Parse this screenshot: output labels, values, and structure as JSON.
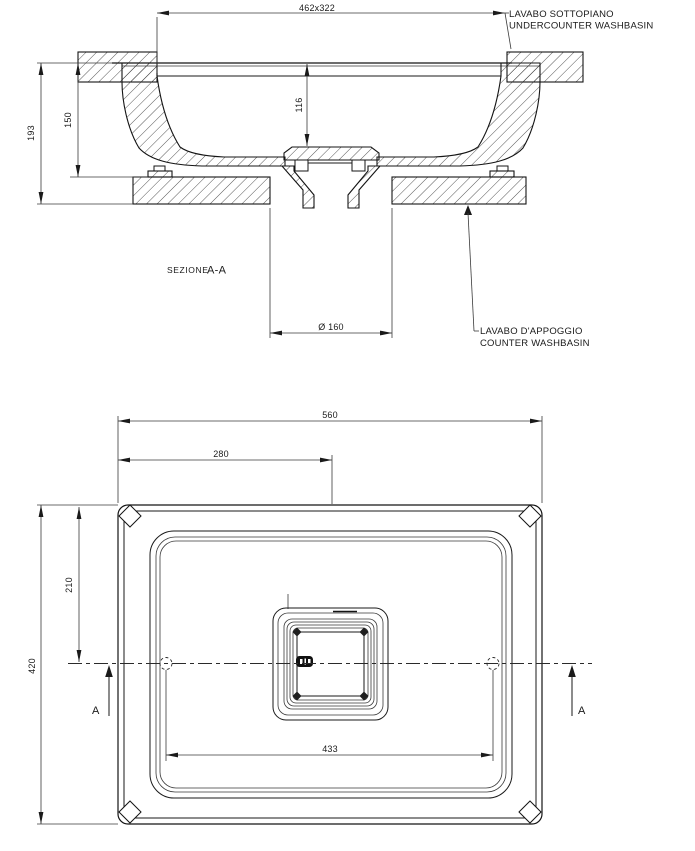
{
  "section": {
    "title_word": "SEZIONE",
    "title_cut": "A-A",
    "dim_top": "462x322",
    "dim_depth": "116",
    "dim_rim_height": "150",
    "dim_total_height": "193",
    "dim_drain": "Ø 160",
    "label_undercounter_line1": "LAVABO SOTTOPIANO",
    "label_undercounter_line2": "UNDERCOUNTER WASHBASIN",
    "label_counter_line1": "LAVABO D'APPOGGIO",
    "label_counter_line2": "COUNTER WASHBASIN"
  },
  "plan": {
    "dim_width": "560",
    "dim_center_x": "280",
    "dim_center_y": "210",
    "dim_height": "420",
    "dim_holes_span": "433",
    "marker_left": "A",
    "marker_right": "A"
  },
  "colors": {
    "ink": "#1a1a1a",
    "dim_lines": "#333333",
    "background": "#ffffff"
  }
}
